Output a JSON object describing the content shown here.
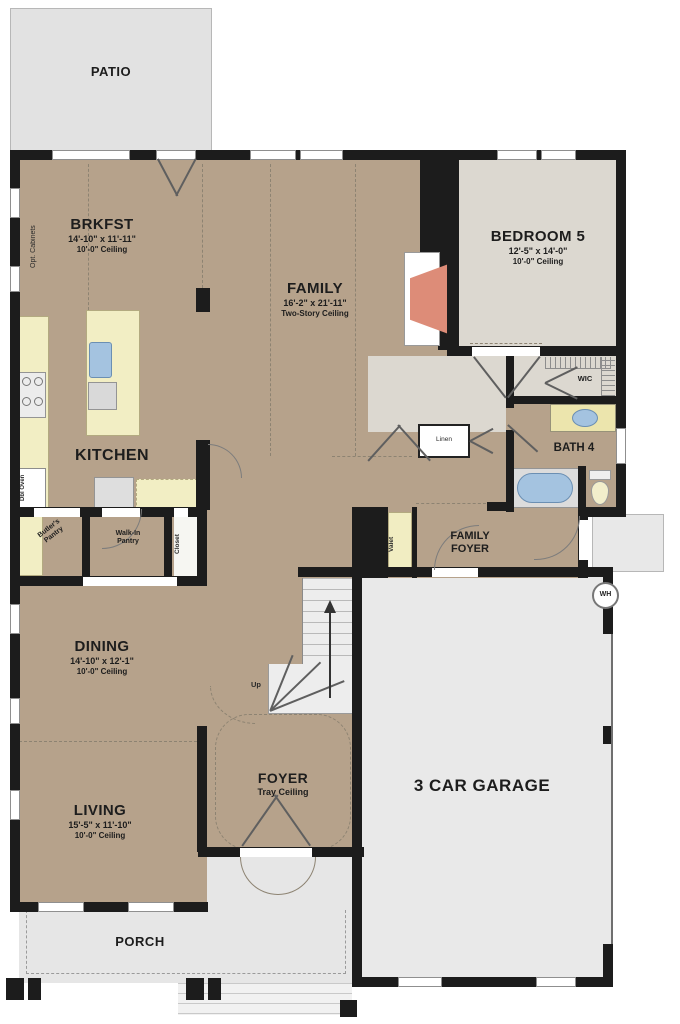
{
  "rooms": {
    "patio": {
      "name": "PATIO"
    },
    "brkfst": {
      "name": "BRKFST",
      "dims": "14'-10\" x 11'-11\"",
      "ceiling": "10'-0\" Ceiling"
    },
    "family": {
      "name": "FAMILY",
      "dims": "16'-2\" x 21'-11\"",
      "ceiling": "Two-Story Ceiling"
    },
    "bedroom5": {
      "name": "BEDROOM 5",
      "dims": "12'-5\" x 14'-0\"",
      "ceiling": "10'-0\" Ceiling"
    },
    "kitchen": {
      "name": "KITCHEN"
    },
    "wic": {
      "name": "WIC"
    },
    "bath4": {
      "name": "BATH 4"
    },
    "familyFoyer": {
      "line1": "FAMILY",
      "line2": "FOYER"
    },
    "dining": {
      "name": "DINING",
      "dims": "14'-10\" x 12'-1\"",
      "ceiling": "10'-0\" Ceiling"
    },
    "living": {
      "name": "LIVING",
      "dims": "15'-5\" x 11'-10\"",
      "ceiling": "10'-0\" Ceiling"
    },
    "foyer": {
      "name": "FOYER",
      "ceiling": "Tray Ceiling"
    },
    "garage": {
      "name": "3 CAR GARAGE"
    },
    "porch": {
      "name": "PORCH"
    }
  },
  "annotations": {
    "optCabinets": "Opt. Cabinets",
    "dblOven": "Dbl Oven",
    "butlersPantry1": "Butler's",
    "butlersPantry2": "Pantry",
    "walkInPantry1": "Walk-In",
    "walkInPantry2": "Pantry",
    "closet": "Closet",
    "linen": "Linen",
    "valet": "Valet",
    "up": "Up",
    "waterHeater": "WH"
  },
  "colors": {
    "wall": "#1c1c1c",
    "room_tan": "#b6a28b",
    "room_beige": "#dcd8d0",
    "exterior_gray": "#e4e4e4",
    "garage_gray": "#e9e9e9",
    "counter_cream": "#f2eec4",
    "fixture_blue": "#a4c3e0",
    "fireplace_salmon": "#dd8c78"
  }
}
